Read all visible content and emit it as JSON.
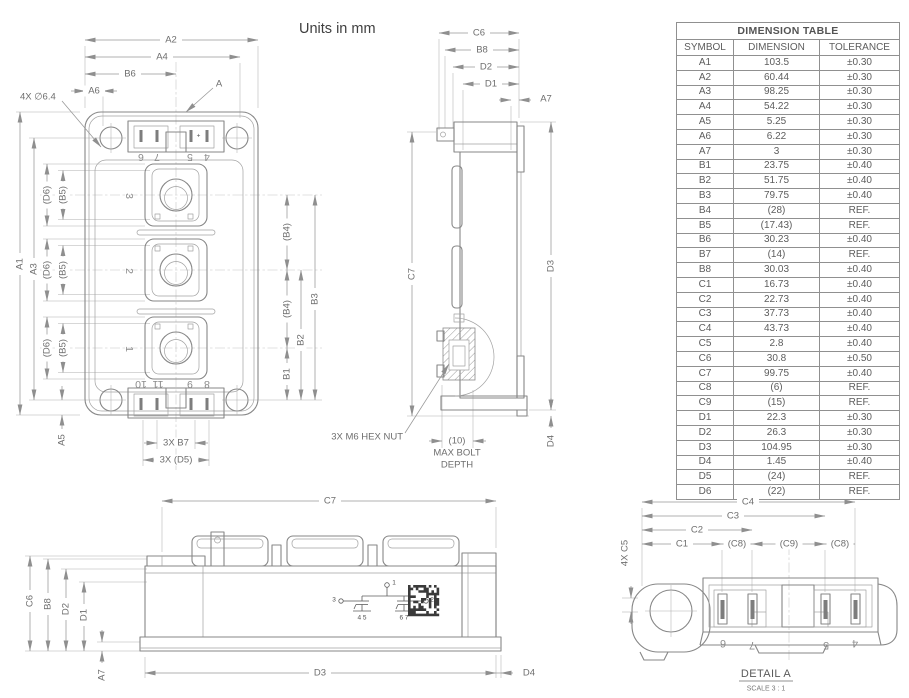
{
  "notes": {
    "units": "Units in mm",
    "hole_callout": "4X ∅6.4",
    "section_marker": "A",
    "hex_nut_callout": "3X M6 HEX NUT",
    "max_bolt": "MAX BOLT",
    "depth": "DEPTH"
  },
  "dim_labels": {
    "a1": "A1",
    "a2": "A2",
    "a3": "A3",
    "a4": "A4",
    "a5": "A5",
    "a6": "A6",
    "a7": "A7",
    "b1": "B1",
    "b2": "B2",
    "b3": "B3",
    "b4": "(B4)",
    "b5": "(B5)",
    "b6": "B6",
    "b7": "3X B7",
    "b8": "B8",
    "c1": "C1",
    "c2": "C2",
    "c3": "C3",
    "c4": "C4",
    "c5": "4X C5",
    "c6": "C6",
    "c7": "C7",
    "c8": "(C8)",
    "c9": "(C9)",
    "d1": "D1",
    "d2": "D2",
    "d3": "D3",
    "d4": "D4",
    "d5": "3X (D5)",
    "d6": "(D6)",
    "bolt_depth": "(10)"
  },
  "front_view": {
    "terminals": [
      "3",
      "2",
      "1"
    ],
    "top_pins": [
      "6",
      "7",
      "5",
      "4"
    ],
    "bottom_pins": [
      "10",
      "11",
      "9",
      "8"
    ],
    "polarity": "+"
  },
  "schematic": {
    "pin_top": "1",
    "pin_left": "3",
    "pin_right": "2",
    "gates_left": "4 5",
    "gates_right": "6 7"
  },
  "detail": {
    "title": "DETAIL A",
    "scale": "SCALE 3 : 1",
    "pins": [
      "6",
      "7",
      "5",
      "4"
    ]
  },
  "table": {
    "title": "DIMENSION TABLE",
    "columns": [
      "SYMBOL",
      "DIMENSION",
      "TOLERANCE"
    ],
    "rows": [
      {
        "symbol": "A1",
        "dimension": "103.5",
        "tolerance": "±0.30"
      },
      {
        "symbol": "A2",
        "dimension": "60.44",
        "tolerance": "±0.30"
      },
      {
        "symbol": "A3",
        "dimension": "98.25",
        "tolerance": "±0.30"
      },
      {
        "symbol": "A4",
        "dimension": "54.22",
        "tolerance": "±0.30"
      },
      {
        "symbol": "A5",
        "dimension": "5.25",
        "tolerance": "±0.30"
      },
      {
        "symbol": "A6",
        "dimension": "6.22",
        "tolerance": "±0.30"
      },
      {
        "symbol": "A7",
        "dimension": "3",
        "tolerance": "±0.30"
      },
      {
        "symbol": "B1",
        "dimension": "23.75",
        "tolerance": "±0.40"
      },
      {
        "symbol": "B2",
        "dimension": "51.75",
        "tolerance": "±0.40"
      },
      {
        "symbol": "B3",
        "dimension": "79.75",
        "tolerance": "±0.40"
      },
      {
        "symbol": "B4",
        "dimension": "(28)",
        "tolerance": "REF."
      },
      {
        "symbol": "B5",
        "dimension": "(17.43)",
        "tolerance": "REF."
      },
      {
        "symbol": "B6",
        "dimension": "30.23",
        "tolerance": "±0.40"
      },
      {
        "symbol": "B7",
        "dimension": "(14)",
        "tolerance": "REF."
      },
      {
        "symbol": "B8",
        "dimension": "30.03",
        "tolerance": "±0.40"
      },
      {
        "symbol": "C1",
        "dimension": "16.73",
        "tolerance": "±0.40"
      },
      {
        "symbol": "C2",
        "dimension": "22.73",
        "tolerance": "±0.40"
      },
      {
        "symbol": "C3",
        "dimension": "37.73",
        "tolerance": "±0.40"
      },
      {
        "symbol": "C4",
        "dimension": "43.73",
        "tolerance": "±0.40"
      },
      {
        "symbol": "C5",
        "dimension": "2.8",
        "tolerance": "±0.40"
      },
      {
        "symbol": "C6",
        "dimension": "30.8",
        "tolerance": "±0.50"
      },
      {
        "symbol": "C7",
        "dimension": "99.75",
        "tolerance": "±0.40"
      },
      {
        "symbol": "C8",
        "dimension": "(6)",
        "tolerance": "REF."
      },
      {
        "symbol": "C9",
        "dimension": "(15)",
        "tolerance": "REF."
      },
      {
        "symbol": "D1",
        "dimension": "22.3",
        "tolerance": "±0.30"
      },
      {
        "symbol": "D2",
        "dimension": "26.3",
        "tolerance": "±0.30"
      },
      {
        "symbol": "D3",
        "dimension": "104.95",
        "tolerance": "±0.30"
      },
      {
        "symbol": "D4",
        "dimension": "1.45",
        "tolerance": "±0.40"
      },
      {
        "symbol": "D5",
        "dimension": "(24)",
        "tolerance": "REF."
      },
      {
        "symbol": "D6",
        "dimension": "(22)",
        "tolerance": "REF."
      }
    ]
  },
  "colors": {
    "line": "#878787",
    "dim_text": "#6e6e6e",
    "table_text": "#5d5d5d"
  }
}
